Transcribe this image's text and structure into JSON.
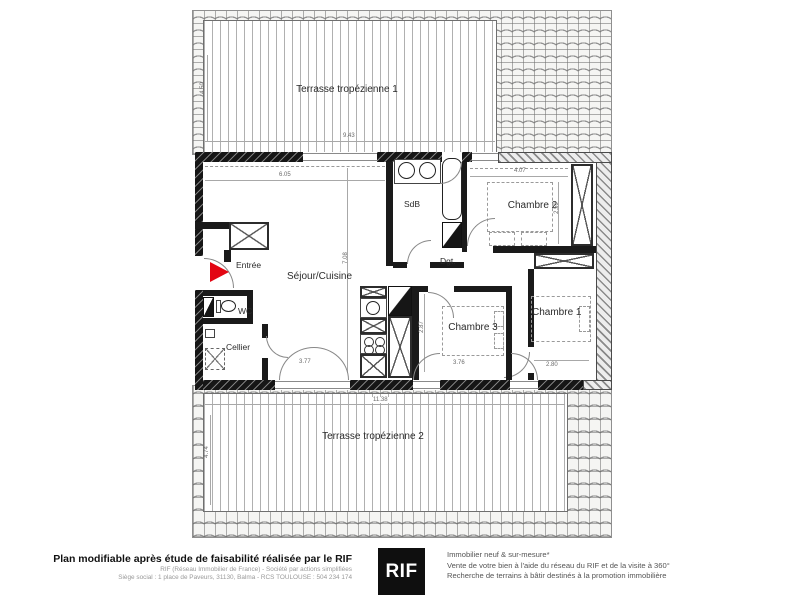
{
  "plan": {
    "terrace1": {
      "label": "Terrasse tropézienne 1",
      "width": "9.43",
      "height": "4.50"
    },
    "terrace2": {
      "label": "Terrasse tropézienne 2",
      "width": "11.38",
      "height": "4.74"
    },
    "rooms": {
      "entree": "Entrée",
      "sejour": "Séjour/Cuisine",
      "sdb": "SdB",
      "wc": "WC",
      "cellier": "Cellier",
      "dgt": "Dgt.",
      "chambre1": "Chambre 1",
      "chambre2": "Chambre 2",
      "chambre3": "Chambre 3"
    },
    "dims": {
      "sejour_width": "6.05",
      "sejour_height": "7.08",
      "sejour_bottom": "3.77",
      "chambre2_width": "4.07",
      "chambre2_height": "2.59",
      "chambre3_width": "3.76",
      "chambre3_height": "2.87",
      "chambre1_width": "2.80"
    }
  },
  "footer": {
    "headline": "Plan modifiable après étude de faisabilité réalisée par le RIF",
    "company_line1": "RIF (Réseau Immobilier de France) - Société par actions simplifiées",
    "company_line2": "Siège social : 1 place de Paveurs, 31130, Balma - RCS TOULOUSE : 504 234 174",
    "logo": "RIF",
    "services_line1": "Immobilier neuf & sur-mesure*",
    "services_line2": "Vente de votre bien à l'aide du réseau du RIF et de la visite à 360°",
    "services_line3": "Recherche de terrains à bâtir destinés à la promotion immobilière"
  },
  "colors": {
    "accent_red": "#e30613",
    "logo_bg": "#0f0f0f",
    "wall": "#161616"
  }
}
